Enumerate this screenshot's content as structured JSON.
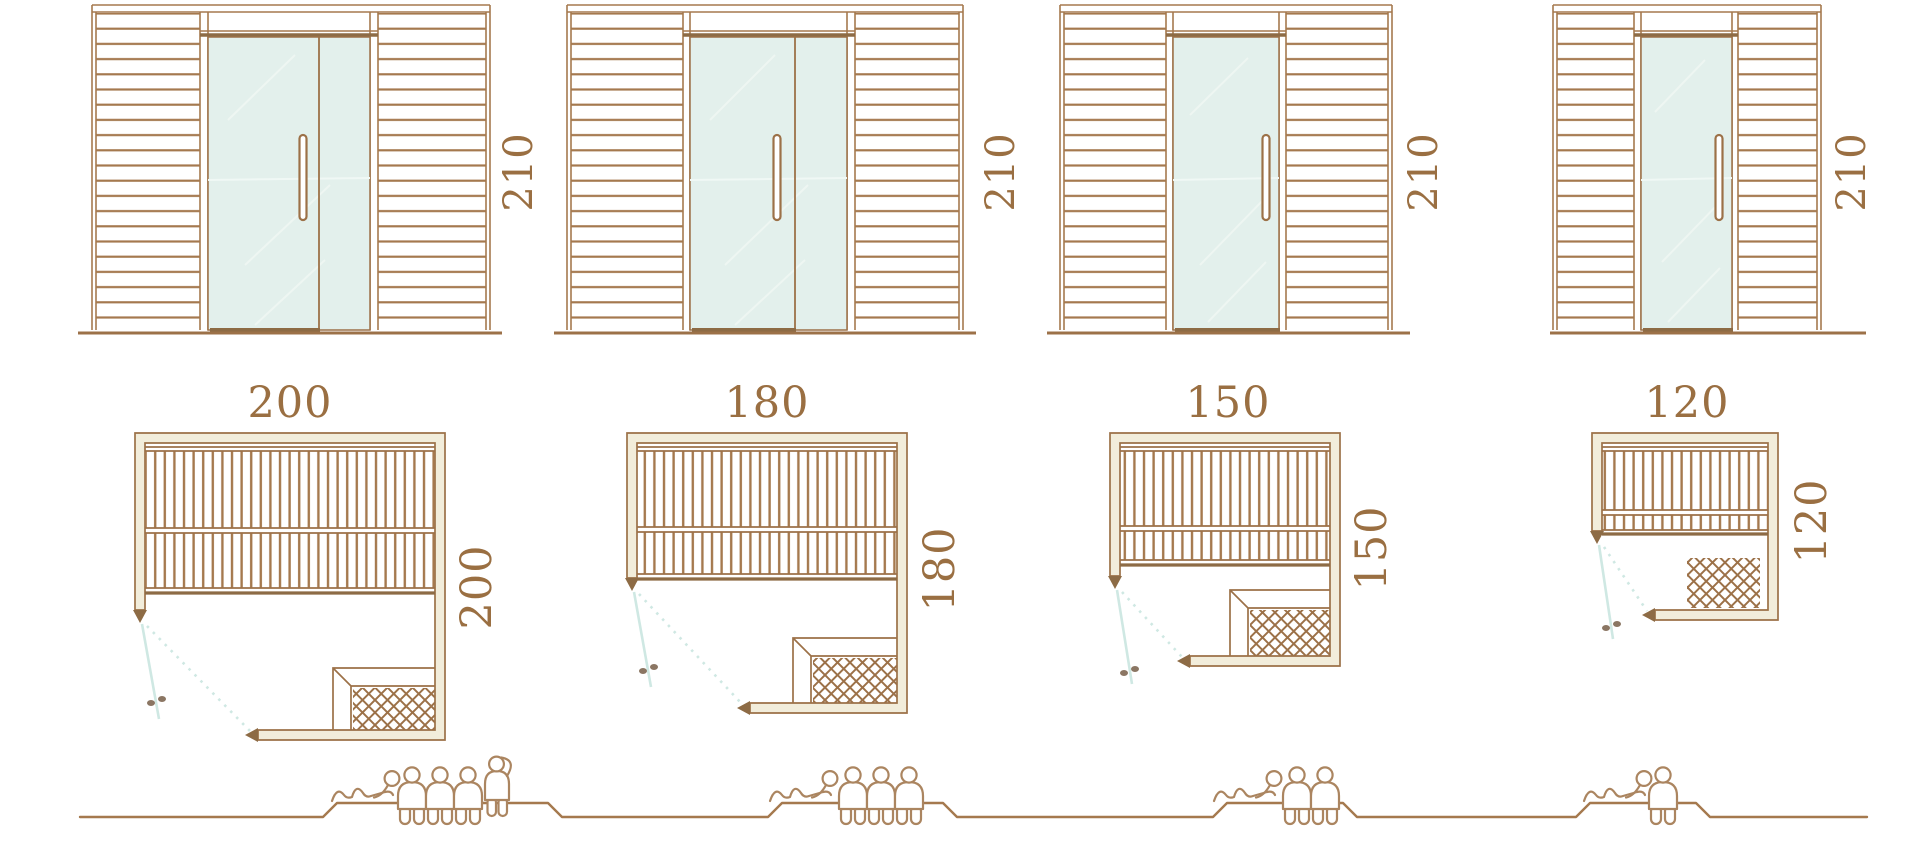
{
  "diagram": {
    "subject": "sauna-cabin-size-comparison",
    "views": [
      "front-elevation",
      "floor-plan",
      "capacity-figures"
    ],
    "model_count": 4
  },
  "models": [
    {
      "width_label": "200",
      "depth_label": "200",
      "height_label": "210",
      "capacity": {
        "lying": 1,
        "seated": 3,
        "standing": 1,
        "total": 5
      }
    },
    {
      "width_label": "180",
      "depth_label": "180",
      "height_label": "210",
      "capacity": {
        "lying": 1,
        "seated": 3,
        "standing": 0,
        "total": 4
      }
    },
    {
      "width_label": "150",
      "depth_label": "150",
      "height_label": "210",
      "capacity": {
        "lying": 1,
        "seated": 2,
        "standing": 0,
        "total": 3
      }
    },
    {
      "width_label": "120",
      "depth_label": "120",
      "height_label": "210",
      "capacity": {
        "lying": 1,
        "seated": 1,
        "standing": 0,
        "total": 2
      }
    }
  ],
  "colors": {
    "wood_outline": "#a5794e",
    "wood_dark": "#8d6b45",
    "dimension_text": "#9a6f42",
    "glass_fill": "#e3f0ec",
    "wall_fill": "#f2eddb",
    "door_swing": "#cfe8e3",
    "handle_dots": "#8b7663",
    "people_outline": "#ab8560",
    "background": "#ffffff"
  },
  "icons": {
    "person_seated": "person-seated-icon",
    "person_lying": "person-lying-icon",
    "person_standing": "person-standing-icon"
  }
}
